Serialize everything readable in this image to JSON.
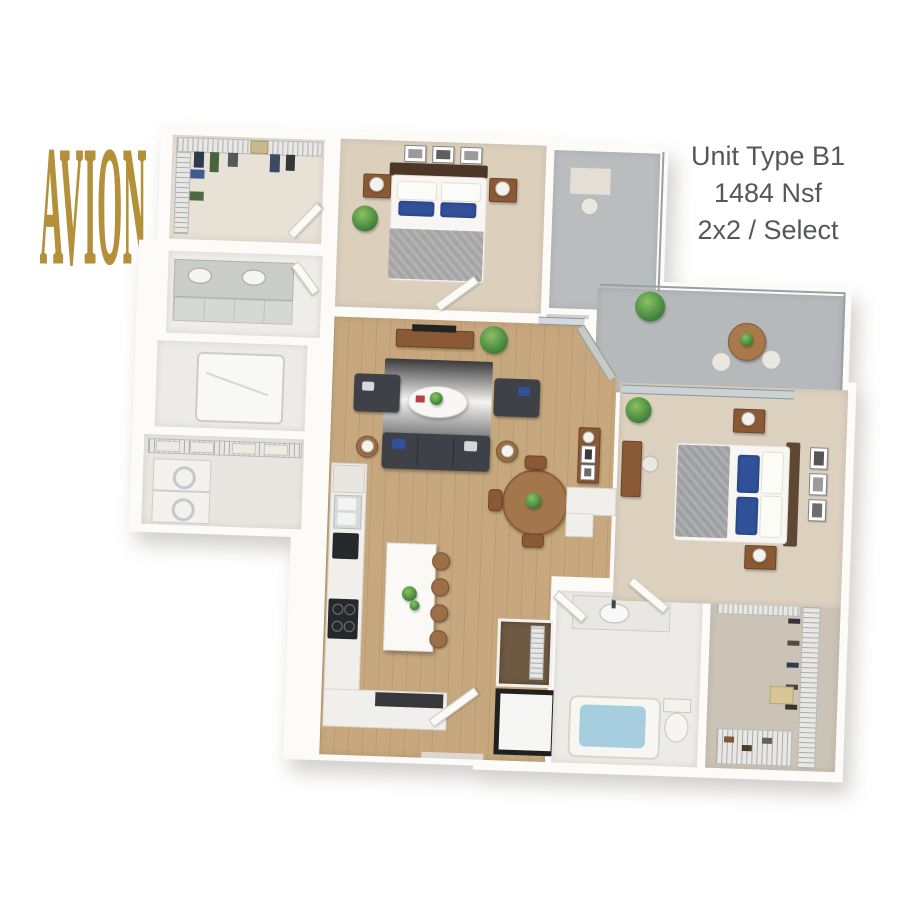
{
  "logo": {
    "text": "AVION",
    "color": "#B5903A"
  },
  "unit_info": {
    "line1": "Unit Type B1",
    "line2": "1484 Nsf",
    "line3": "2x2 / Select",
    "text_color": "#56575B"
  },
  "floor_plan": {
    "type": "3d-rendered-apartment-floor-plan",
    "bedrooms": 2,
    "bathrooms": 2,
    "rooms": [
      "walk-in-closet-1",
      "primary-bedroom",
      "primary-bathroom",
      "shower-room",
      "laundry",
      "living-room",
      "kitchen",
      "dining-area",
      "balcony",
      "second-bedroom",
      "second-bathroom",
      "walk-in-closet-2",
      "pantry",
      "entry"
    ],
    "colors": {
      "wall": "#FCFBF8",
      "carpet": "#DCCFBC",
      "wood_floor": "#C7A87E",
      "balcony_concrete": "#B7BBBD",
      "bath_tile": "#EDEBE7",
      "sofa_dark": "#3E4147",
      "accent_wood": "#8A5A36",
      "pillow_blue": "#31519A",
      "tub_water": "#A7CEDE",
      "plant_green": "#4E8F43"
    }
  }
}
